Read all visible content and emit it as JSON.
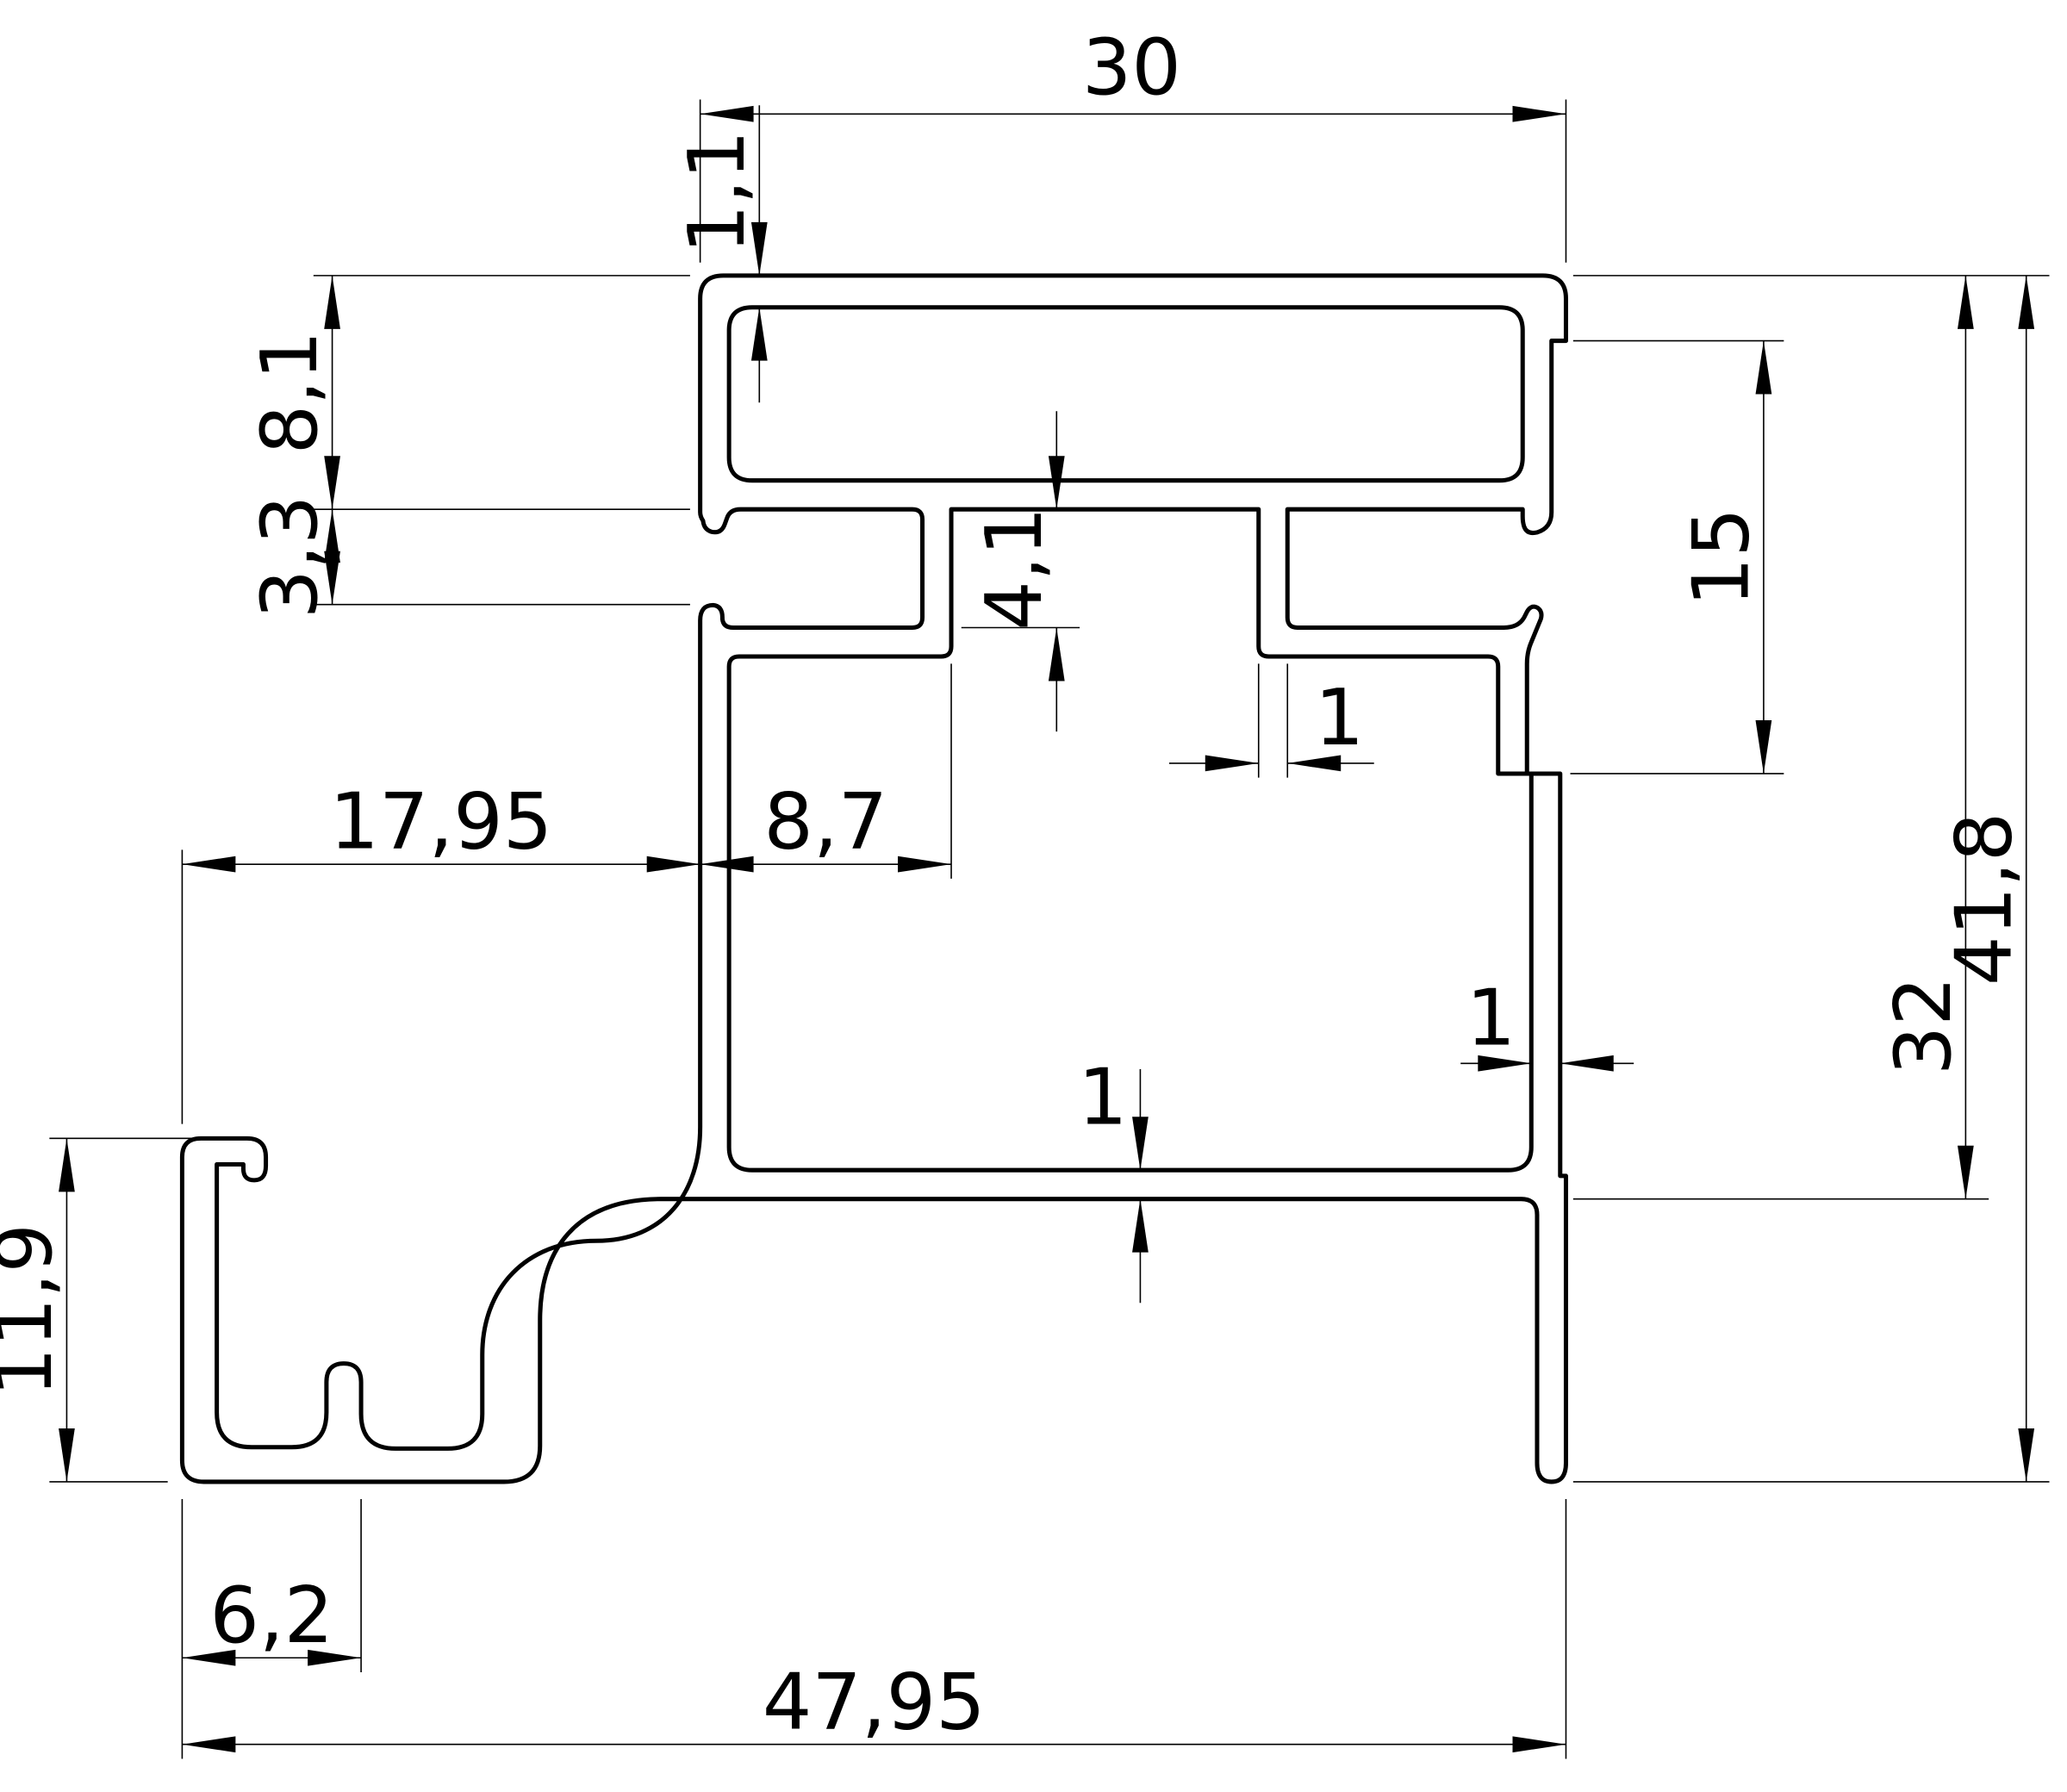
{
  "drawing": {
    "kind": "technical-drawing",
    "subject": "aluminium-profile-cross-section",
    "background_color": "#ffffff",
    "line_color": "#000000",
    "dimensions": {
      "top_width": "30",
      "top_wall_thickness": "1,1",
      "left_upper_height": "8,1",
      "left_slot_mouth": "3,3",
      "slot_inner_height": "4,1",
      "right_step_height": "15",
      "body_height": "32",
      "total_height": "41,8",
      "left_offset": "17,95",
      "slot_depth": "8,7",
      "slot_wall_thickness": "1",
      "right_wall_thickness": "1",
      "bottom_wall_thickness": "1",
      "hook_height": "11,9",
      "hook_width": "6,2",
      "total_width": "47,95"
    }
  }
}
